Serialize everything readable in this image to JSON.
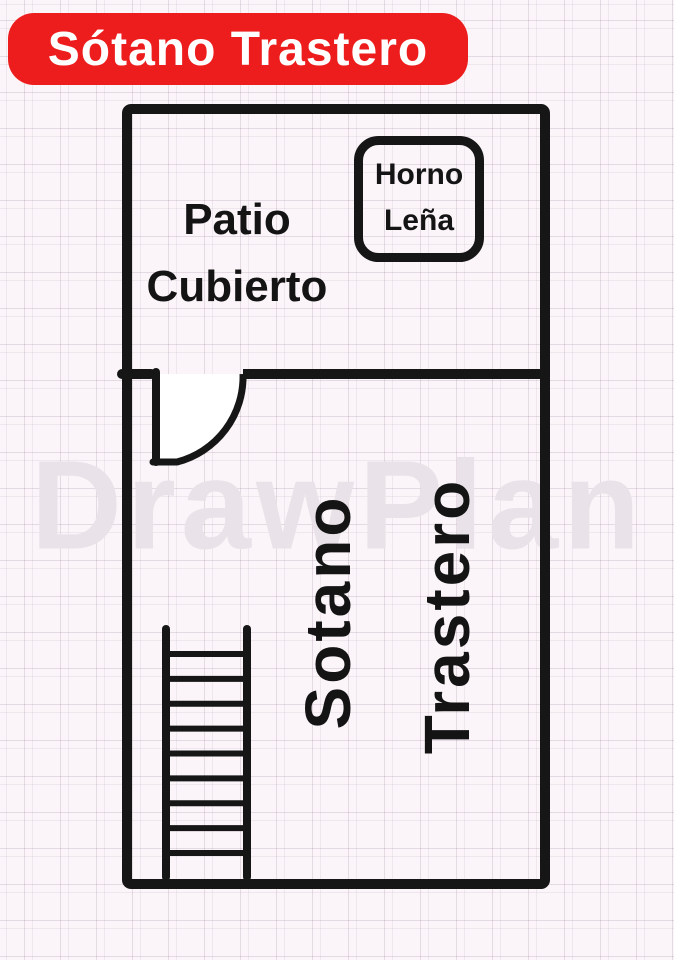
{
  "page": {
    "background": "#fbf5f9",
    "grid_line_color": "#e4dce4"
  },
  "banner": {
    "label": "Sótano Trastero",
    "bg_color": "#ee1d1d",
    "text_color": "#ffffff"
  },
  "watermark": {
    "text": "DrawPlan",
    "color": "#e9e2e8"
  },
  "plan": {
    "wall_color": "#161616",
    "patio": {
      "line1": "Patio",
      "line2": "Cubierto"
    },
    "horno": {
      "line1": "Horno",
      "line2": "Leña"
    },
    "sotano": {
      "word1": "Sotano",
      "word2": "Trastero"
    },
    "stairs": {
      "rungs": 9
    }
  }
}
